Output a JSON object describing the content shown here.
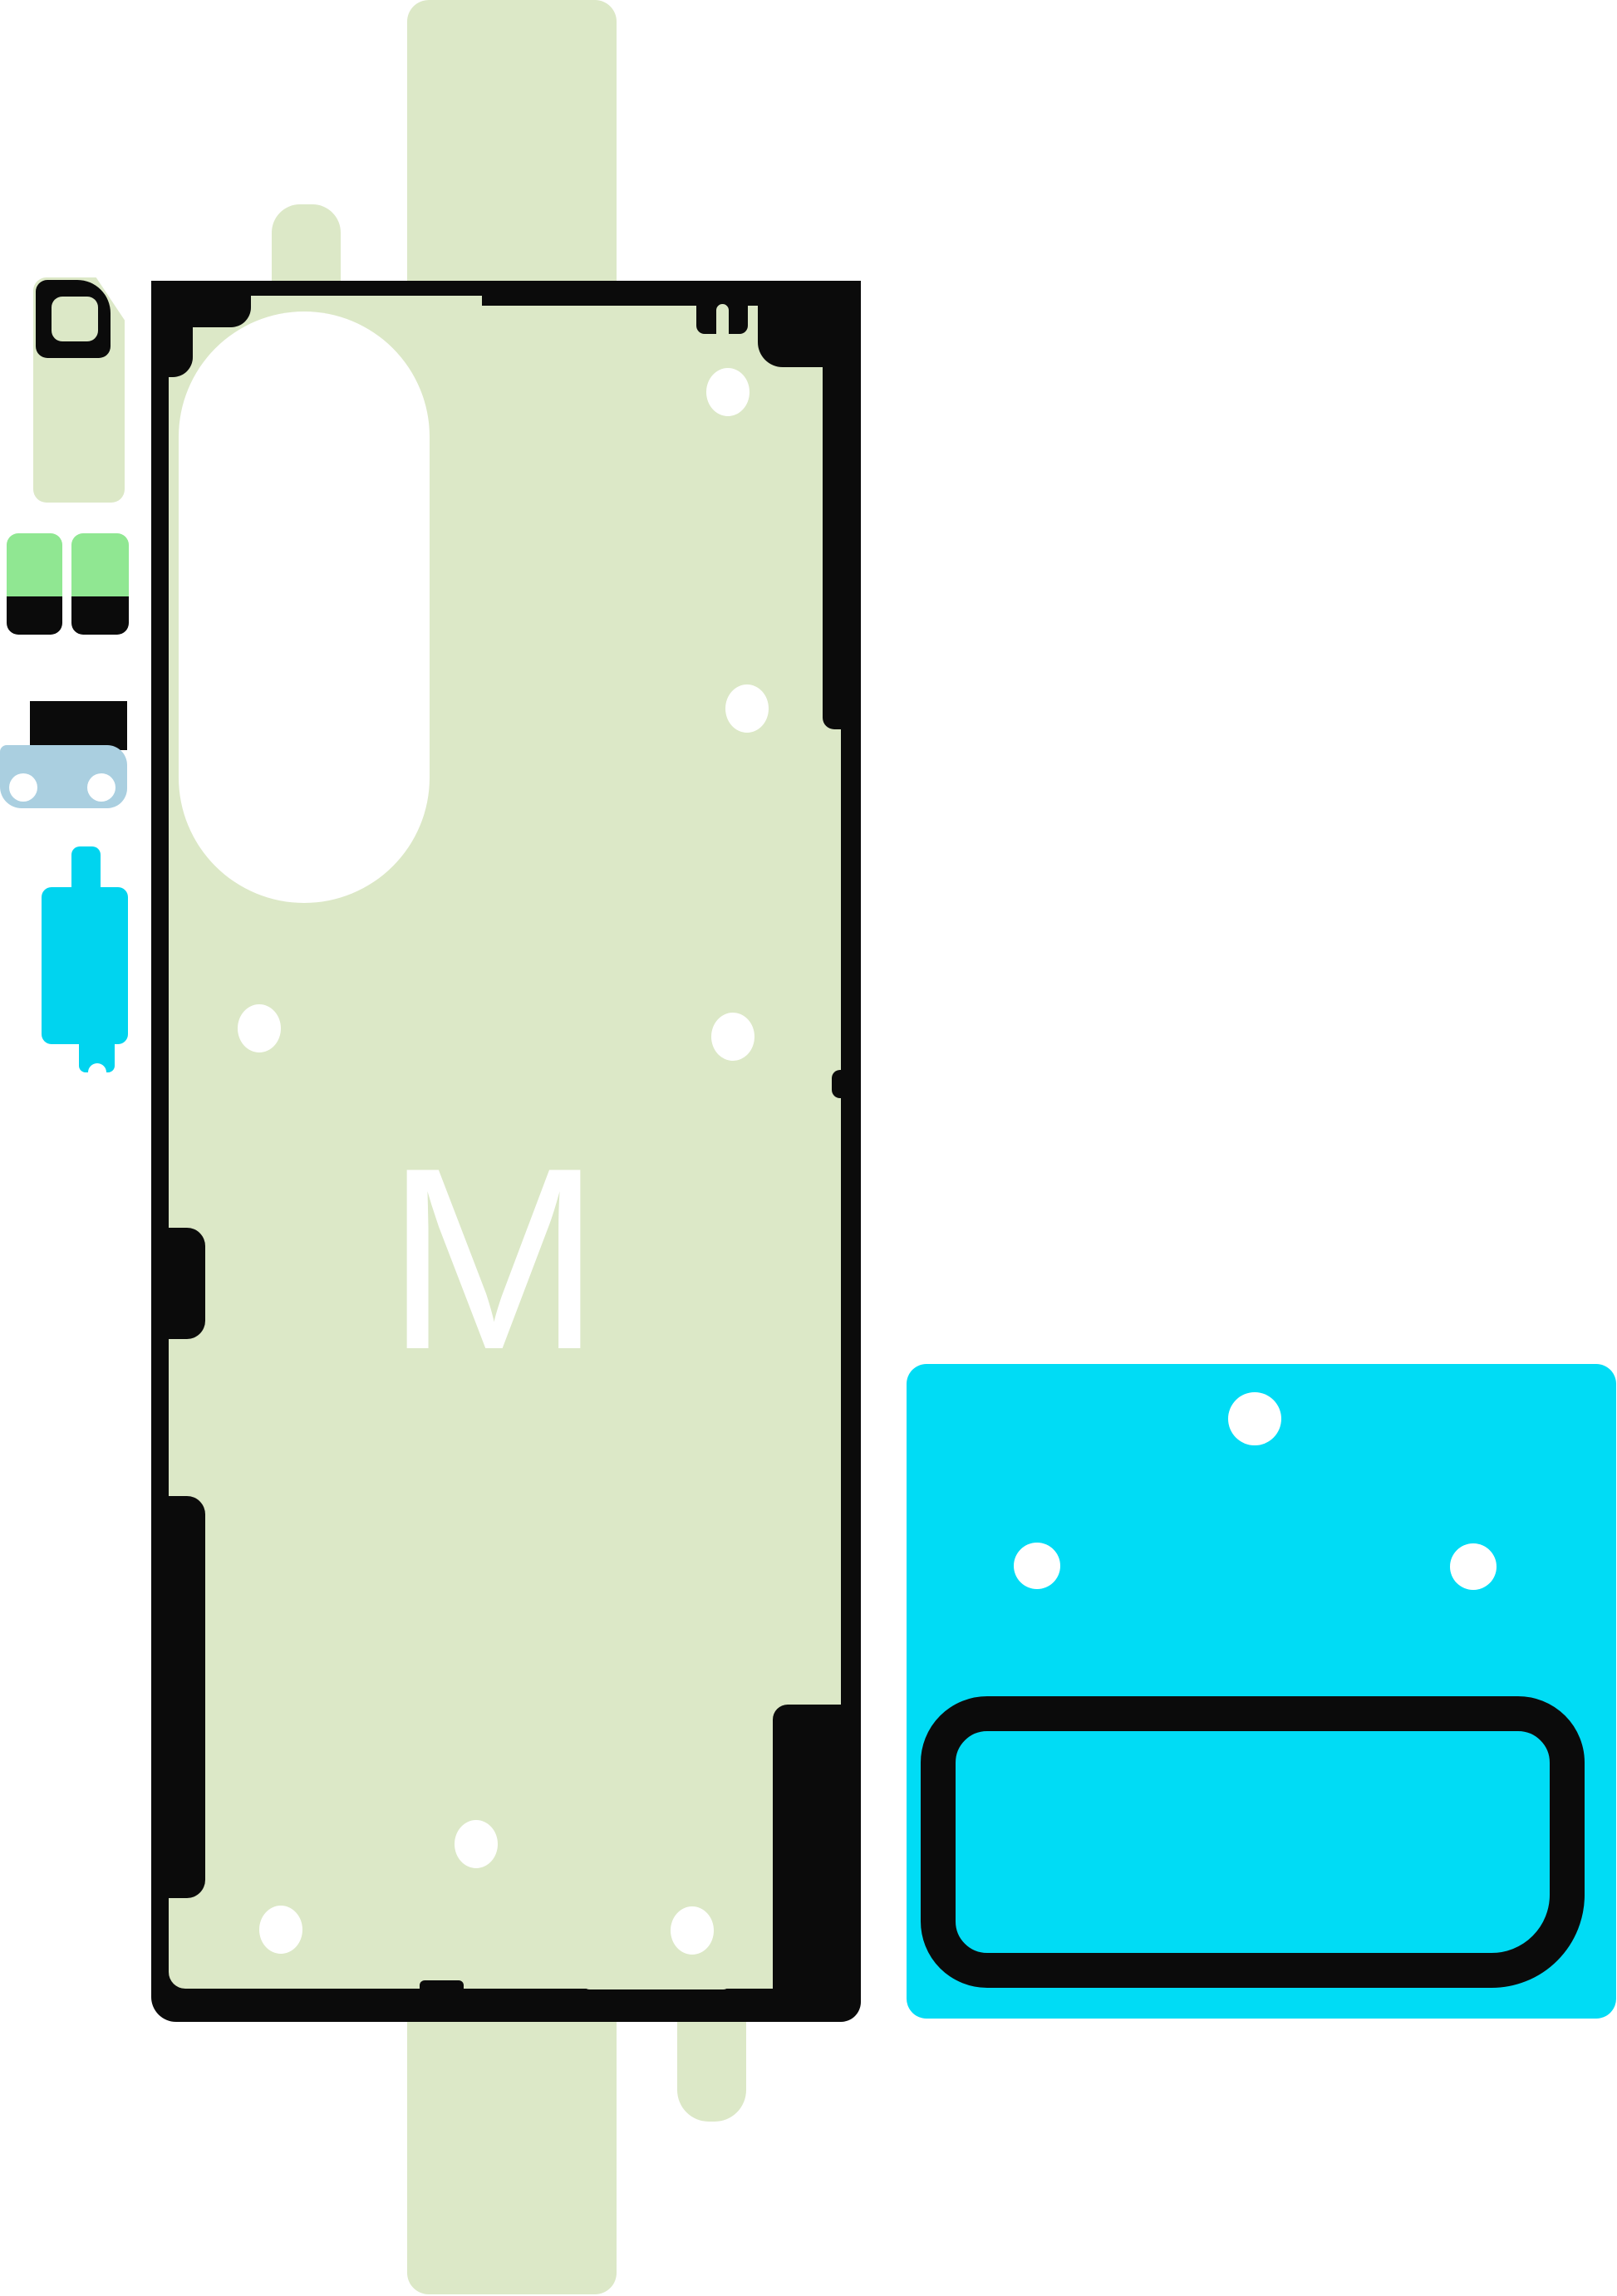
{
  "title": "phone-rework-adhesive-kit",
  "sheet": {
    "watermark": "M"
  },
  "colors": {
    "sage": "#dce8c7",
    "bright-green": "#90e792",
    "cyan-small": "#00d4ef",
    "cyan-square": "#00dcf5",
    "light-blue": "#aacfe0",
    "black": "#0b0b0b",
    "white": "#ffffff"
  }
}
